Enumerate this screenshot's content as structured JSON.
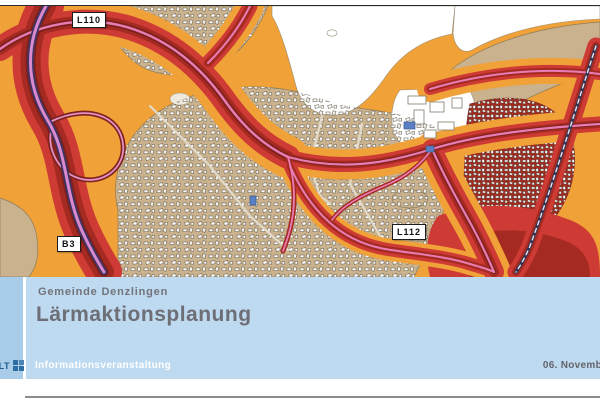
{
  "map": {
    "name": "noise-action-plan-map",
    "road_labels": [
      {
        "id": "l110",
        "text": "L110"
      },
      {
        "id": "b3",
        "text": "B3"
      },
      {
        "id": "l112",
        "text": "L112"
      }
    ],
    "palette": {
      "noise_orange": "#f0a137",
      "noise_red": "#ce3a34",
      "noise_dark_red": "#a52a22",
      "noise_maroon": "#7e211c",
      "settlement_tan": "#c9b28d",
      "road_pink": "#e87db5",
      "motorway_purple": "#3f3366",
      "railway_dark": "#343454",
      "special_building_blue": "#5b7fc4"
    }
  },
  "footer": {
    "kicker": "Gemeinde Denzlingen",
    "title": "Lärmaktionsplanung",
    "logo_text": "ULT",
    "event_label": "Informationsveranstaltung",
    "date_label": "06. Novemb",
    "background_blue": "#bddaf0",
    "strip_blue": "#a9cde9",
    "logo_blue": "#1e5c94"
  }
}
